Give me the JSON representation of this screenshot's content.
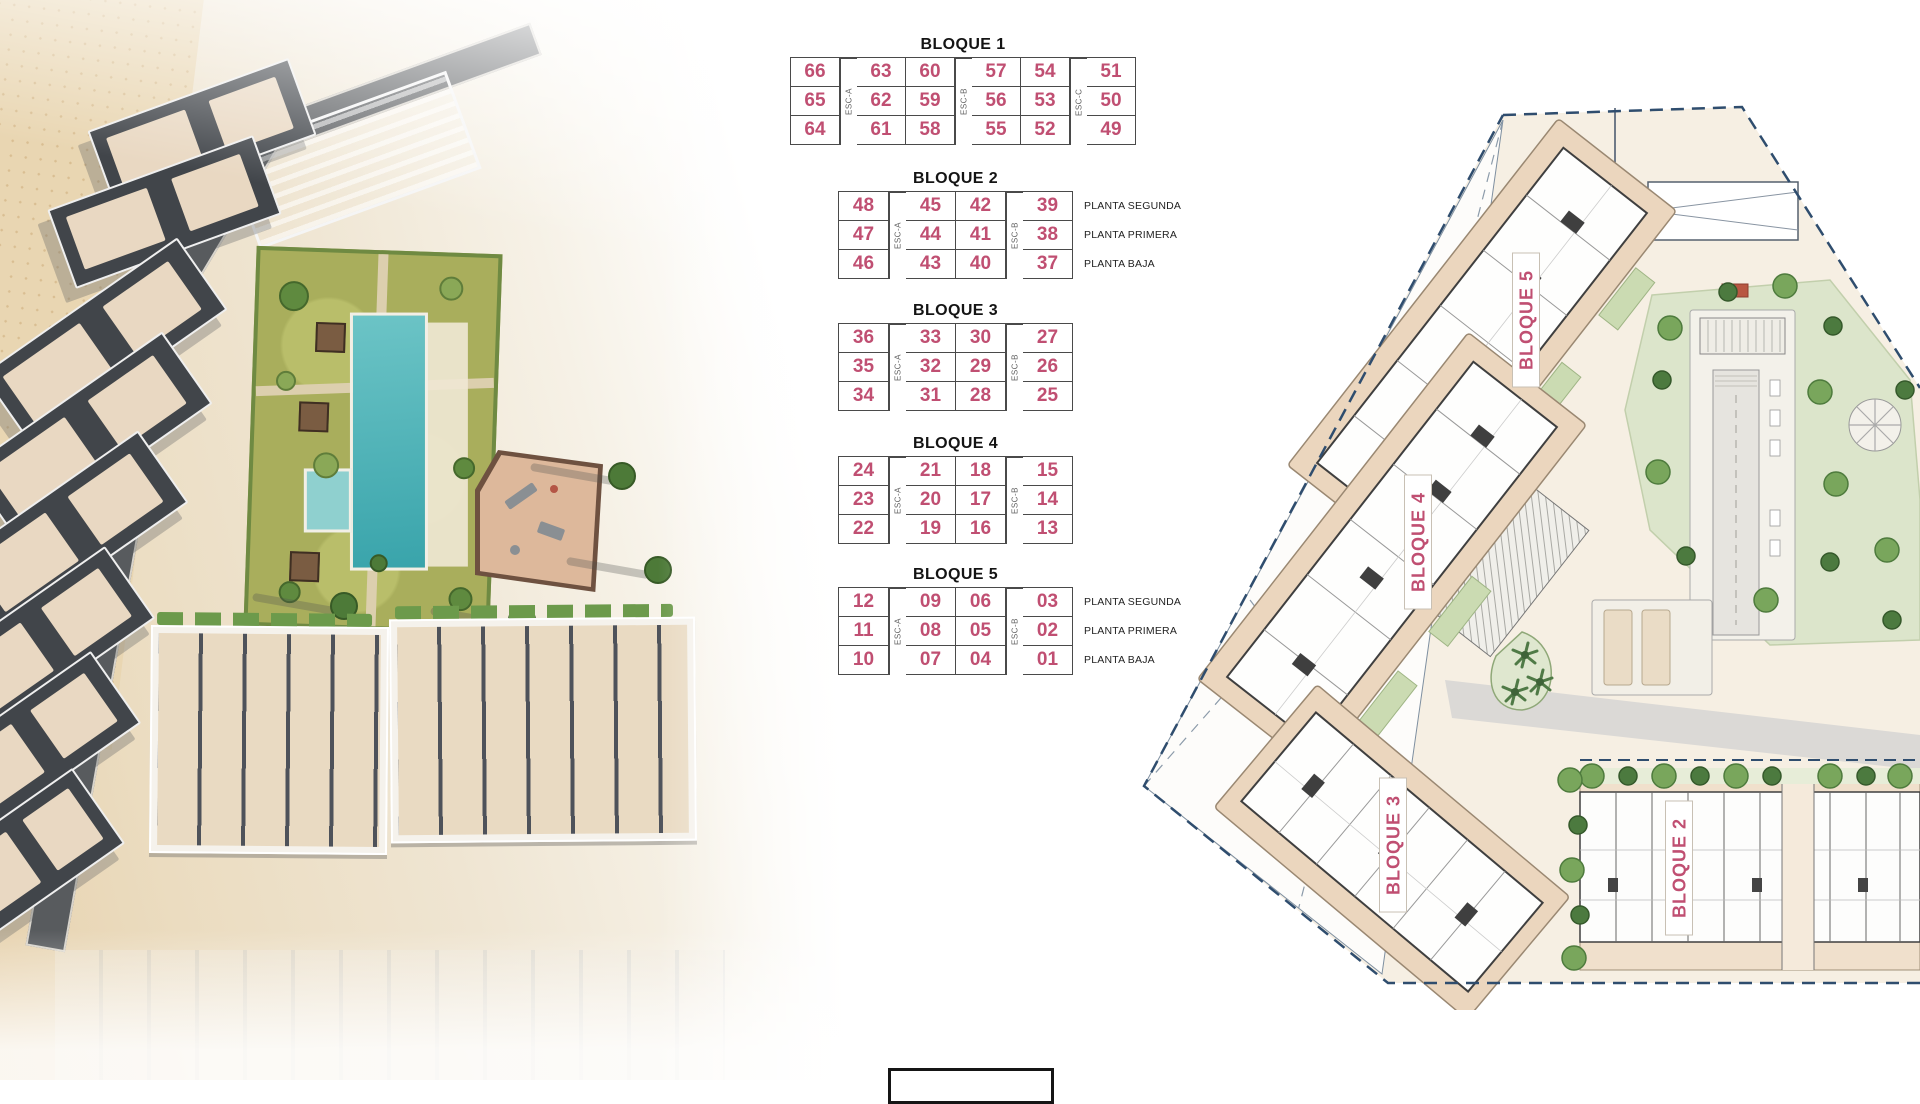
{
  "page": {
    "width": 1920,
    "height": 1080,
    "background": "#FFFFFF"
  },
  "colors": {
    "accent_pink": "#C04F72",
    "title_black": "#141414",
    "table_line": "#4A4A4A",
    "esc_gray": "#5F5F5F",
    "boundary_navy": "#2F4D6E",
    "terrace_tan": "#EBD6BE",
    "plan_green": "#DCE5CB",
    "pool_teal": "#45AEB4"
  },
  "unit_tables": [
    {
      "title": "BLOQUE 1",
      "structure": [
        "u",
        "s",
        "u",
        "u",
        "s",
        "u",
        "u",
        "s",
        "u"
      ],
      "stairs": [
        "ESC-A",
        "ESC-B",
        "ESC-C"
      ],
      "rows": [
        [
          "66",
          "63",
          "60",
          "57",
          "54",
          "51"
        ],
        [
          "65",
          "62",
          "59",
          "56",
          "53",
          "50"
        ],
        [
          "64",
          "61",
          "58",
          "55",
          "52",
          "49"
        ]
      ],
      "floor_labels": []
    },
    {
      "title": "BLOQUE 2",
      "structure": [
        "u",
        "s",
        "u",
        "u",
        "s",
        "u"
      ],
      "stairs": [
        "ESC-A",
        "ESC-B"
      ],
      "rows": [
        [
          "48",
          "45",
          "42",
          "39"
        ],
        [
          "47",
          "44",
          "41",
          "38"
        ],
        [
          "46",
          "43",
          "40",
          "37"
        ]
      ],
      "floor_labels": [
        "PLANTA SEGUNDA",
        "PLANTA PRIMERA",
        "PLANTA BAJA"
      ]
    },
    {
      "title": "BLOQUE 3",
      "structure": [
        "u",
        "s",
        "u",
        "u",
        "s",
        "u"
      ],
      "stairs": [
        "ESC-A",
        "ESC-B"
      ],
      "rows": [
        [
          "36",
          "33",
          "30",
          "27"
        ],
        [
          "35",
          "32",
          "29",
          "26"
        ],
        [
          "34",
          "31",
          "28",
          "25"
        ]
      ],
      "floor_labels": []
    },
    {
      "title": "BLOQUE 4",
      "structure": [
        "u",
        "s",
        "u",
        "u",
        "s",
        "u"
      ],
      "stairs": [
        "ESC-A",
        "ESC-B"
      ],
      "rows": [
        [
          "24",
          "21",
          "18",
          "15"
        ],
        [
          "23",
          "20",
          "17",
          "14"
        ],
        [
          "22",
          "19",
          "16",
          "13"
        ]
      ],
      "floor_labels": []
    },
    {
      "title": "BLOQUE 5",
      "structure": [
        "u",
        "s",
        "u",
        "u",
        "s",
        "u"
      ],
      "stairs": [
        "ESC-A",
        "ESC-B"
      ],
      "rows": [
        [
          "12",
          "09",
          "06",
          "03"
        ],
        [
          "11",
          "08",
          "05",
          "02"
        ],
        [
          "10",
          "07",
          "04",
          "01"
        ]
      ],
      "floor_labels": [
        "PLANTA SEGUNDA",
        "PLANTA PRIMERA",
        "PLANTA BAJA"
      ]
    }
  ],
  "site_plan": {
    "block_labels": [
      "BLOQUE 5",
      "BLOQUE 4",
      "BLOQUE 3",
      "BLOQUE 2"
    ]
  }
}
